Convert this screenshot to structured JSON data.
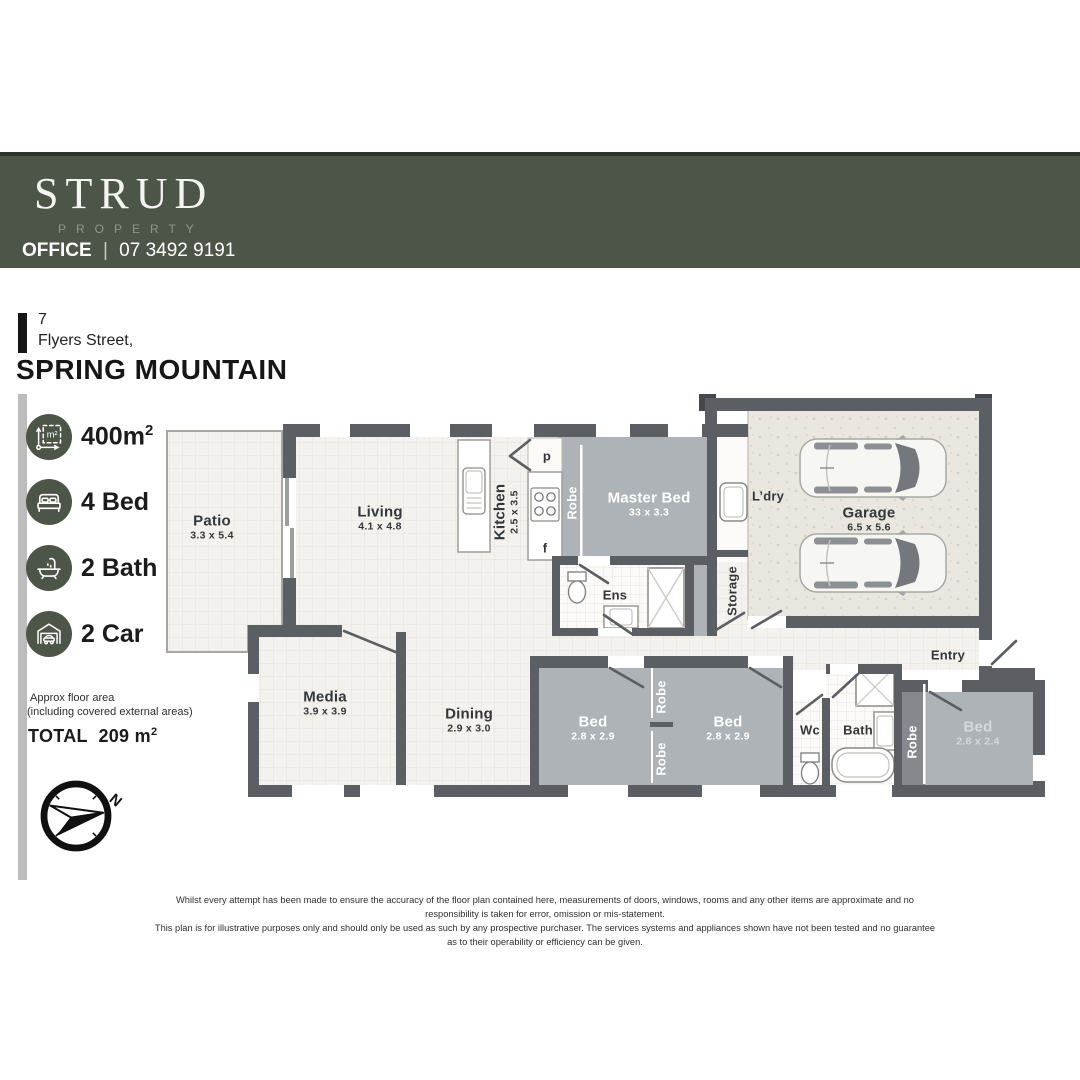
{
  "header": {
    "brand": "STRUD",
    "brand_sub": "PROPERTY",
    "office_label": "OFFICE",
    "office_sep": "|",
    "office_phone": "07 3492 9191"
  },
  "address": {
    "street_number": "7",
    "street": "Flyers Street,",
    "suburb": "SPRING MOUNTAIN"
  },
  "stats": [
    {
      "icon": "area-icon",
      "value": "400m",
      "sup": "2"
    },
    {
      "icon": "bed-icon",
      "value": "4 Bed"
    },
    {
      "icon": "bath-icon",
      "value": "2 Bath"
    },
    {
      "icon": "car-icon",
      "value": "2 Car"
    }
  ],
  "floor_area": {
    "line1": "Approx floor area",
    "line2": "(including covered external areas)",
    "total_label": "TOTAL",
    "total_value": "209 m",
    "total_sup": "2"
  },
  "compass": {
    "north_label": "N"
  },
  "rooms": {
    "patio": {
      "name": "Patio",
      "dims": "3.3 x 5.4"
    },
    "living": {
      "name": "Living",
      "dims": "4.1 x 4.8"
    },
    "kitchen": {
      "name": "Kitchen",
      "dims": "2.5 x 3.5"
    },
    "pantry": "p",
    "fridge": "f",
    "robe_master": "Robe",
    "master": {
      "name": "Master Bed",
      "dims": "33 x 3.3"
    },
    "ldry": "L’dry",
    "garage": {
      "name": "Garage",
      "dims": "6.5 x 5.6"
    },
    "storage": "Storage",
    "ens": "Ens",
    "media": {
      "name": "Media",
      "dims": "3.9 x 3.9"
    },
    "dining": {
      "name": "Dining",
      "dims": "2.9 x 3.0"
    },
    "bed1": {
      "name": "Bed",
      "dims": "2.8 x 2.9"
    },
    "robe_top": "Robe",
    "robe_bottom": "Robe",
    "bed2": {
      "name": "Bed",
      "dims": "2.8 x 2.9"
    },
    "wc": "Wc",
    "bath": "Bath",
    "robe3": "Robe",
    "bed3": {
      "name": "Bed",
      "dims": "2.8 x 2.4"
    },
    "entry": "Entry"
  },
  "disclaimer": {
    "line1": "Whilst every attempt has been made to ensure the accuracy of the floor plan contained here, measurements of doors, windows, rooms and any other items are approximate and no responsibility is taken for error, omission or mis-statement.",
    "line2": "This plan is for illustrative purposes only and should only be used as such by any prospective purchaser. The services systems and appliances shown have not been tested and no guarantee as to their operability or efficiency can be given."
  },
  "colors": {
    "brand_green": "#4c5547",
    "wall": "#5b5e62",
    "bedroom_gray": "#aeb3b7",
    "floor": "#f4f2ee"
  }
}
